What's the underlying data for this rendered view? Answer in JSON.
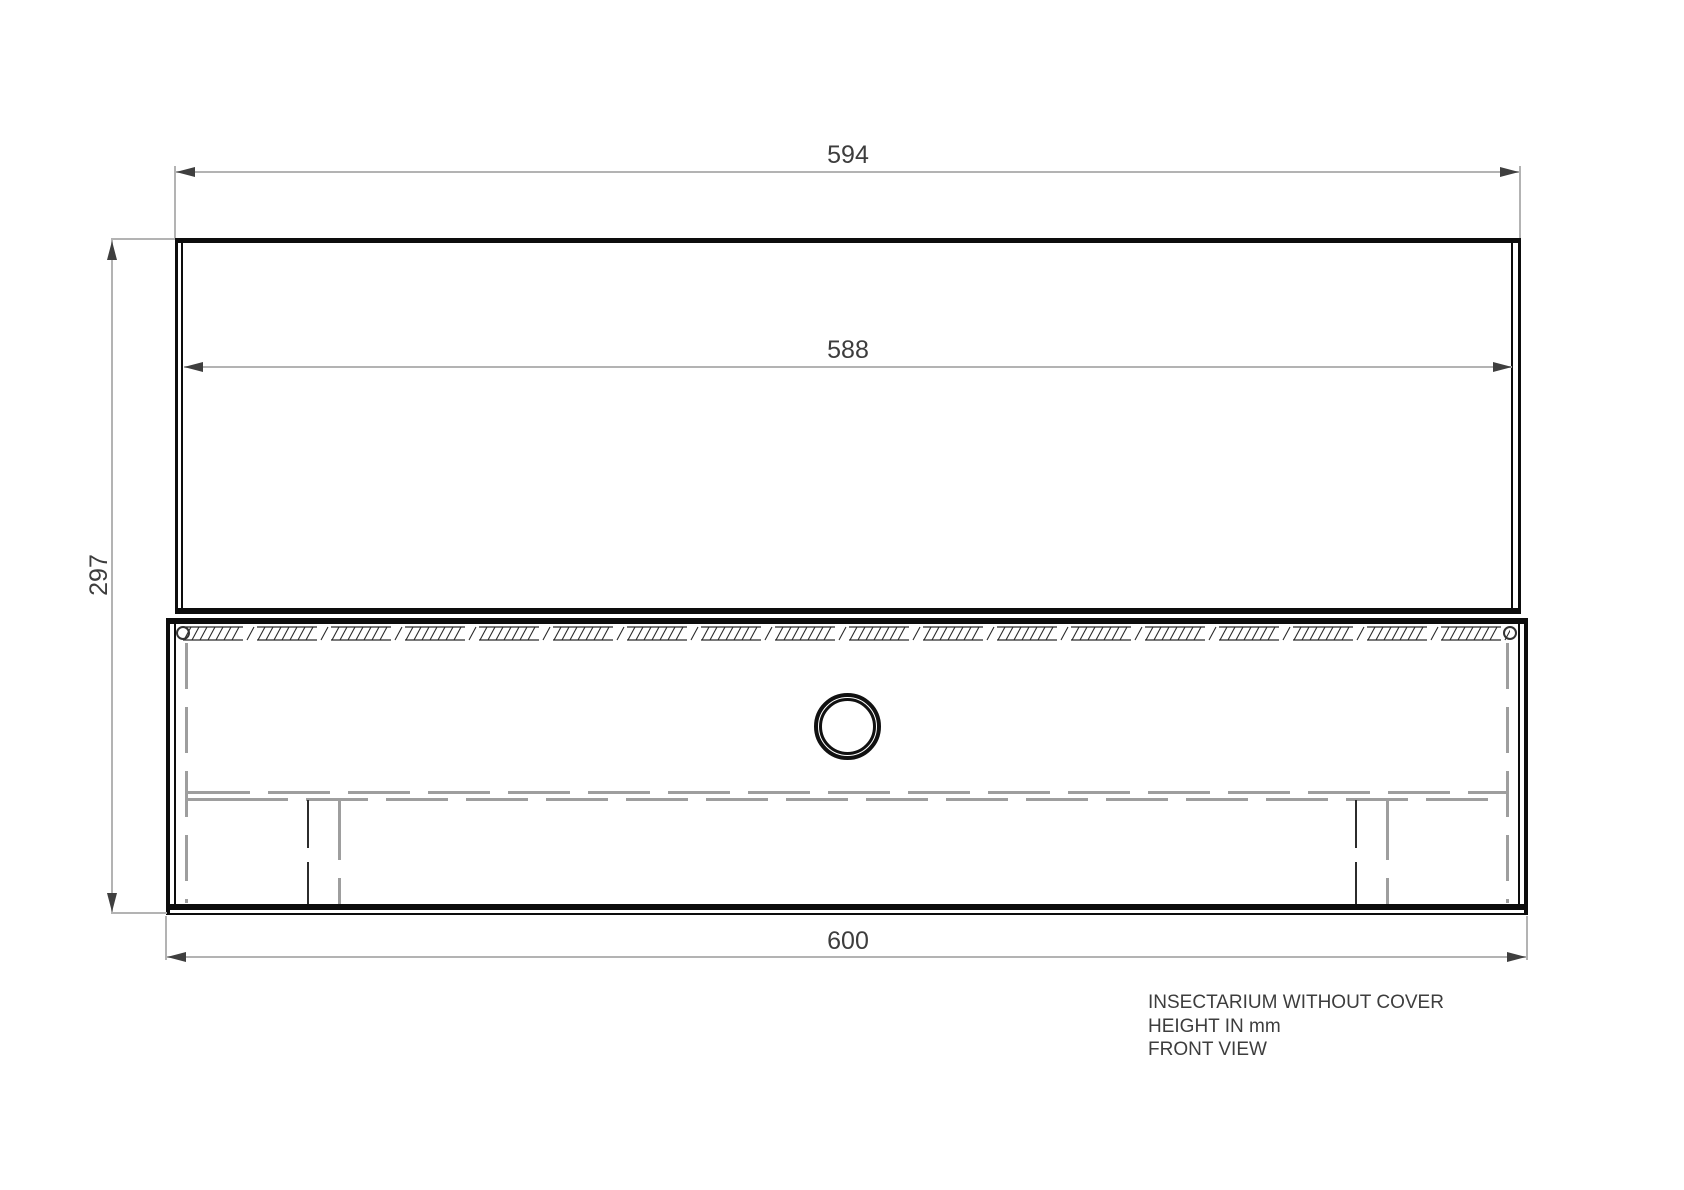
{
  "drawing": {
    "dimensions": {
      "top_outer_width_mm": "594",
      "inner_width_mm": "588",
      "overall_height_mm": "297",
      "base_width_mm": "600"
    },
    "notes": {
      "line1": "INSECTARIUM WITHOUT COVER",
      "line2": "HEIGHT IN mm",
      "line3": "FRONT VIEW"
    },
    "colors": {
      "structure_line": "#0d0d0d",
      "dimension_line": "#b3b3b3",
      "dimension_text": "#3d3d3d",
      "hidden_line": "#9e9e9e",
      "background": "#ffffff"
    }
  }
}
